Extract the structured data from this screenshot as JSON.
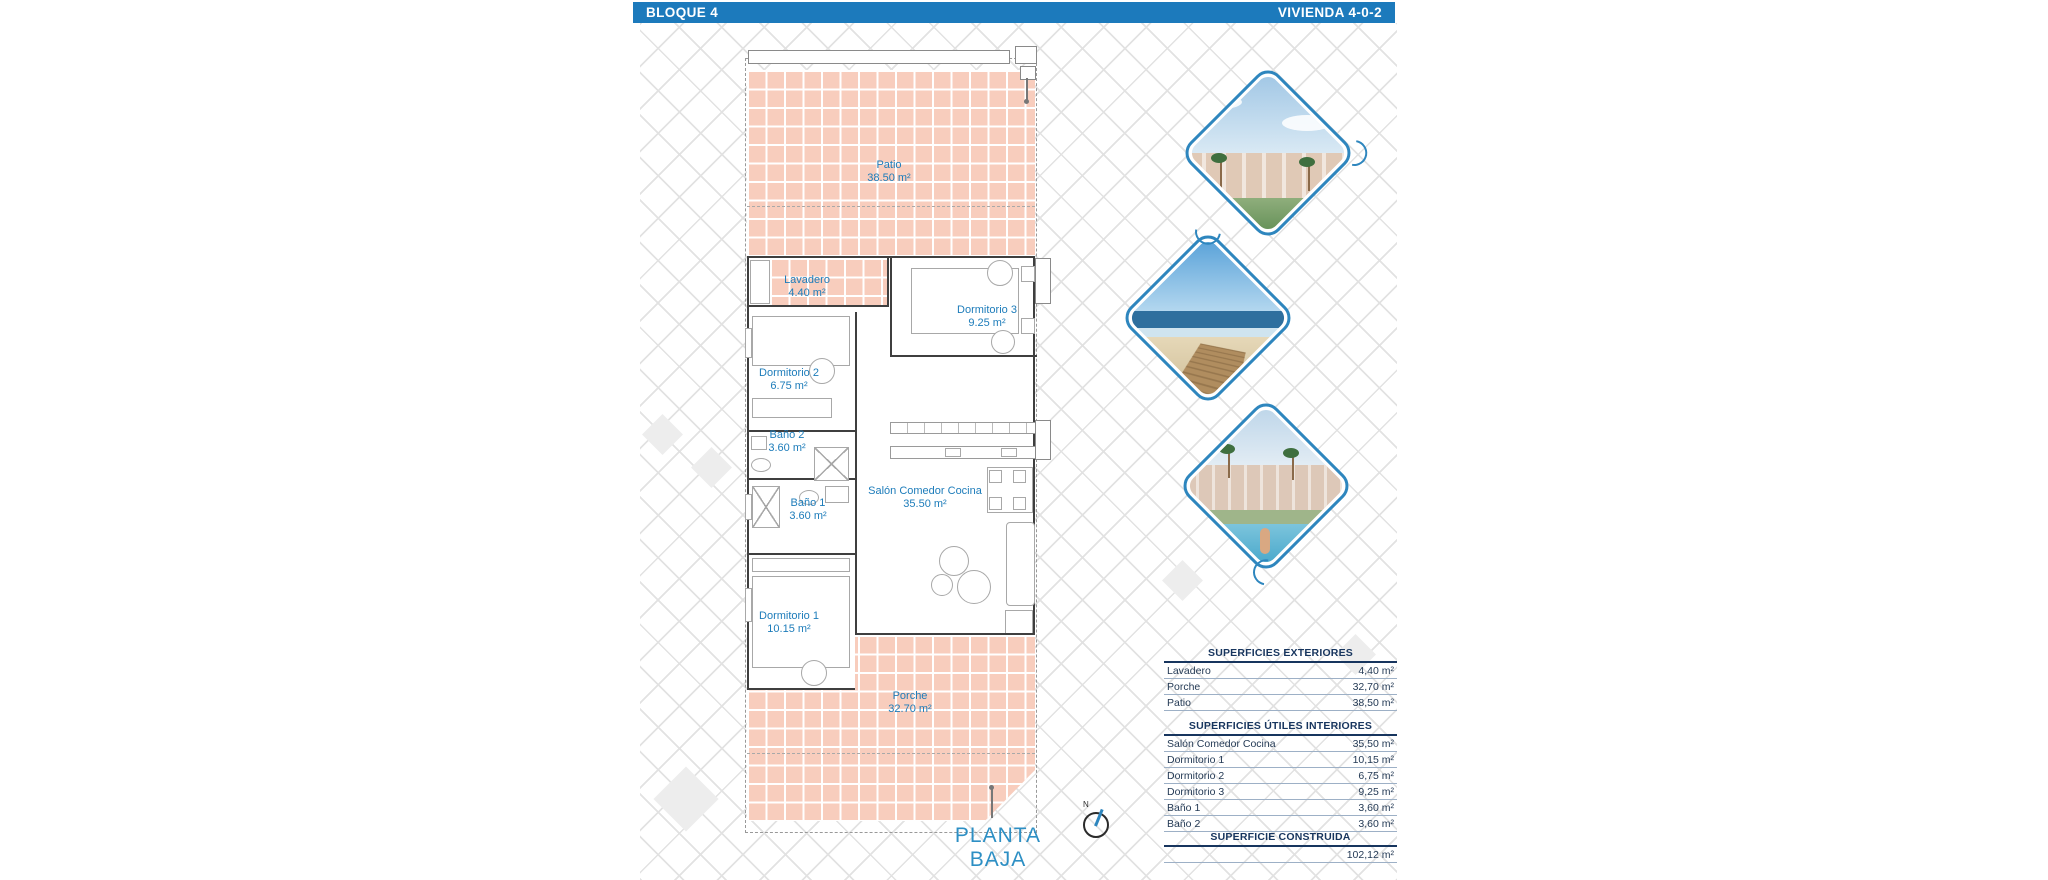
{
  "header": {
    "left": "BLOQUE 4",
    "right": "VIVIENDA 4-0-2"
  },
  "colors": {
    "accent_blue": "#1c7abc",
    "label_blue": "#1d7cba",
    "table_navy": "#17355e",
    "tile_salmon": "#f8cdbd",
    "planta_blue": "#2d8fc4",
    "diamond_border": "#2e86be"
  },
  "plan": {
    "title": "PLANTA BAJA",
    "compass_label": "N",
    "rooms": [
      {
        "name": "Patio",
        "area": "38.50 m²"
      },
      {
        "name": "Lavadero",
        "area": "4.40 m²"
      },
      {
        "name": "Dormitorio 3",
        "area": "9.25 m²"
      },
      {
        "name": "Dormitorio 2",
        "area": "6.75 m²"
      },
      {
        "name": "Baño 2",
        "area": "3.60 m²"
      },
      {
        "name": "Baño 1",
        "area": "3.60 m²"
      },
      {
        "name": "Salón Comedor Cocina",
        "area": "35.50 m²"
      },
      {
        "name": "Dormitorio 1",
        "area": "10.15 m²"
      },
      {
        "name": "Porche",
        "area": "32.70 m²"
      }
    ]
  },
  "gallery": {
    "images": [
      {
        "name": "resort-buildings-render"
      },
      {
        "name": "beach-boardwalk-photo"
      },
      {
        "name": "pool-render"
      }
    ]
  },
  "tables": {
    "exteriores": {
      "title": "SUPERFICIES EXTERIORES",
      "rows": [
        {
          "label": "Lavadero",
          "value": "4,40 m²"
        },
        {
          "label": "Porche",
          "value": "32,70 m²"
        },
        {
          "label": "Patio",
          "value": "38,50 m²"
        }
      ]
    },
    "interiores": {
      "title": "SUPERFICIES ÚTILES INTERIORES",
      "rows": [
        {
          "label": "Salón Comedor Cocina",
          "value": "35,50 m²"
        },
        {
          "label": "Dormitorio 1",
          "value": "10,15 m²"
        },
        {
          "label": "Dormitorio 2",
          "value": "6,75 m²"
        },
        {
          "label": "Dormitorio 3",
          "value": "9,25 m²"
        },
        {
          "label": "Baño 1",
          "value": "3,60 m²"
        },
        {
          "label": "Baño 2",
          "value": "3,60 m²"
        }
      ]
    },
    "construida": {
      "title": "SUPERFICIE CONSTRUIDA",
      "value": "102,12 m²"
    }
  }
}
